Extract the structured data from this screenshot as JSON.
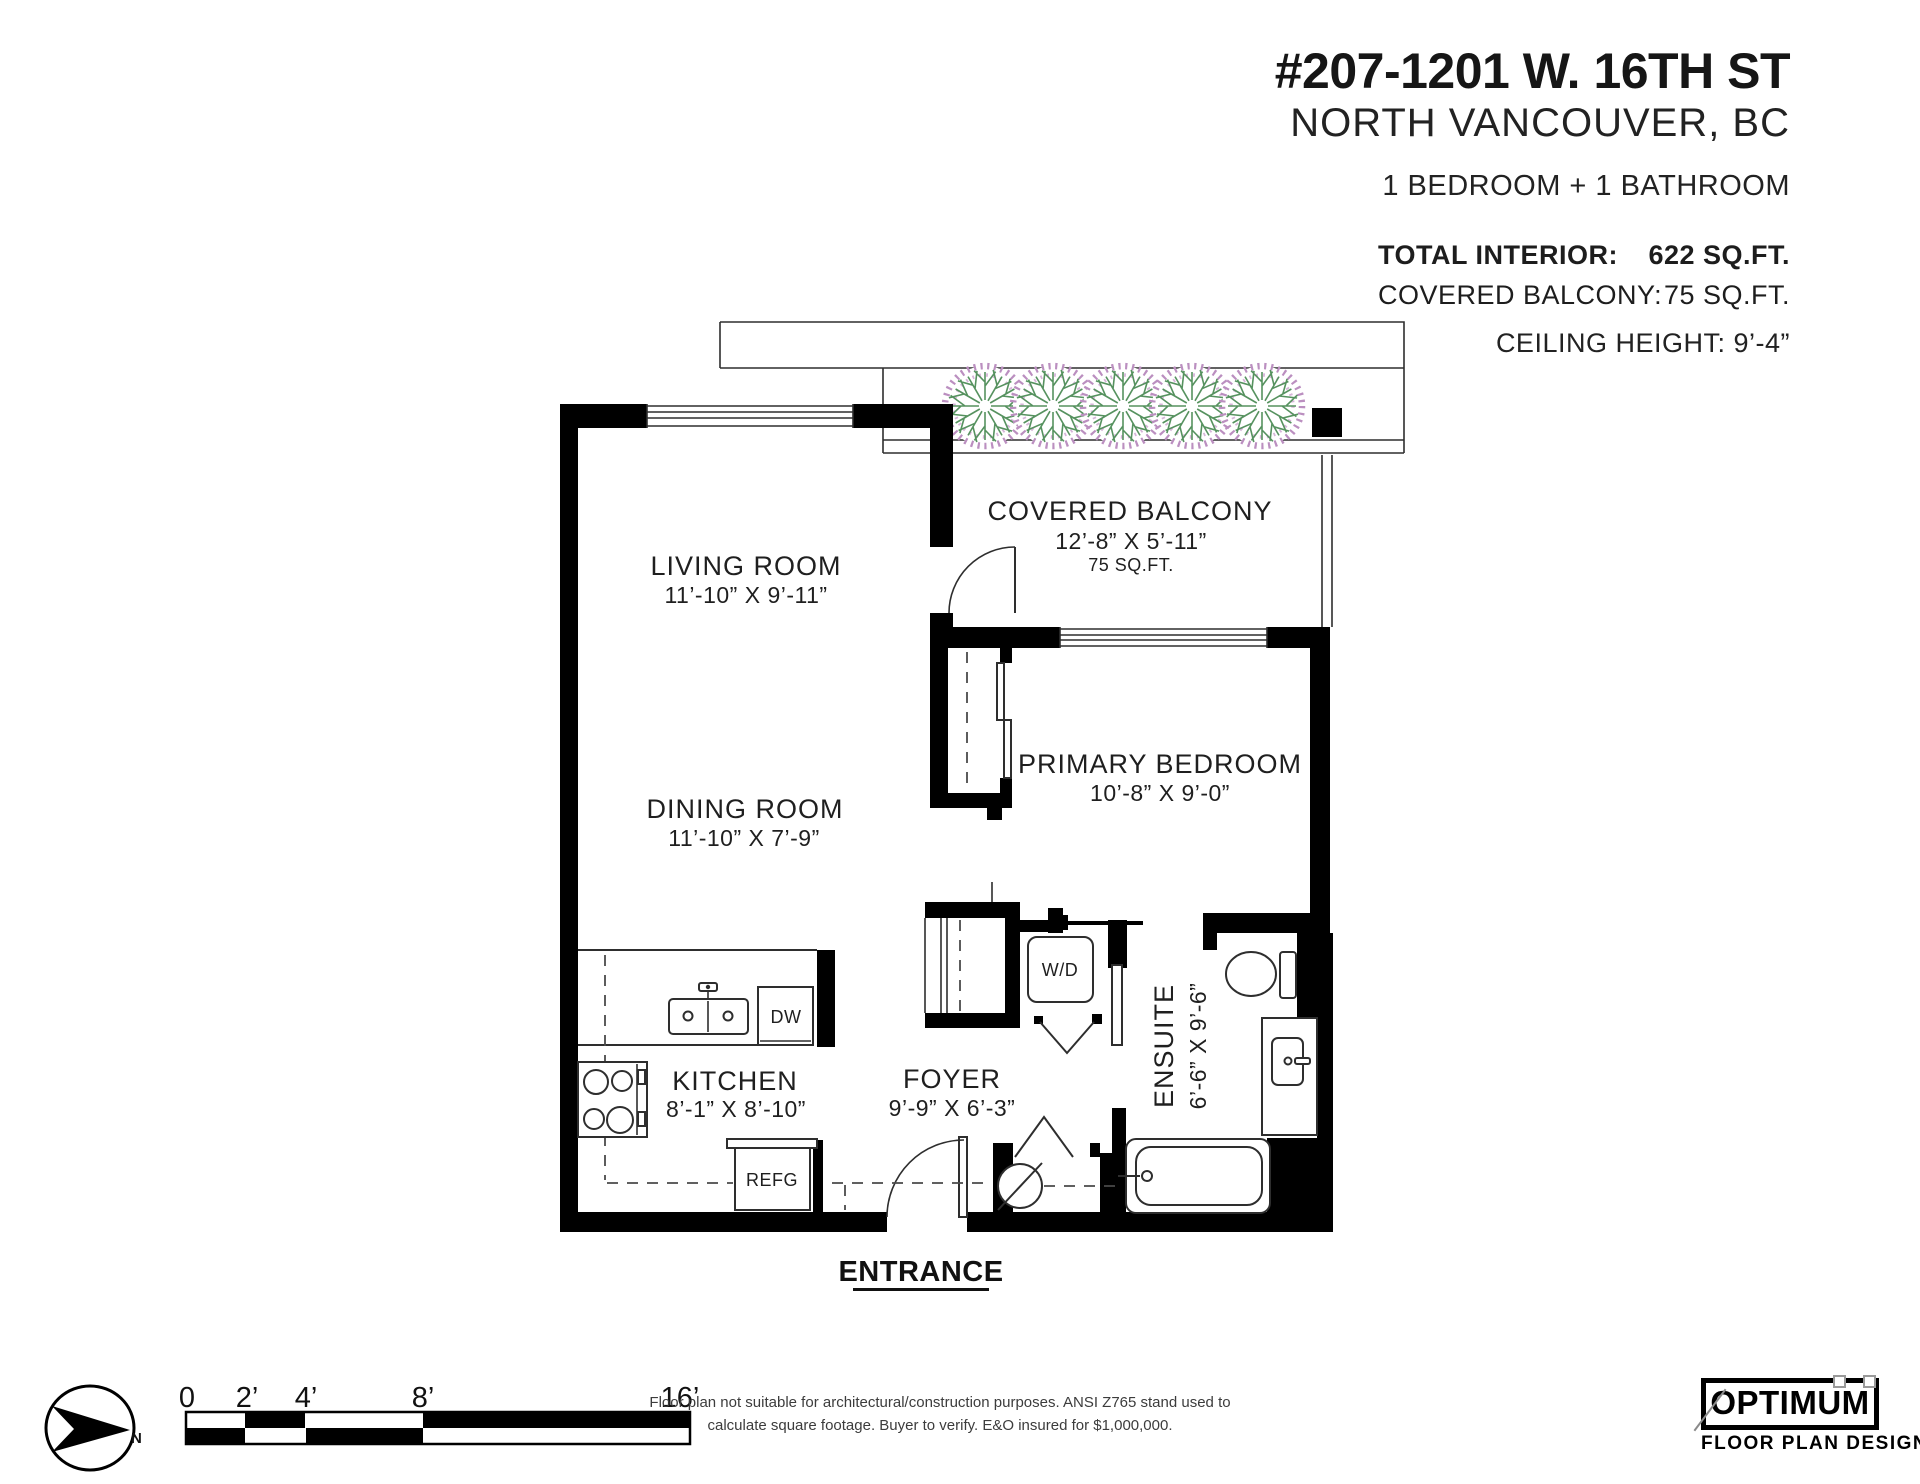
{
  "header": {
    "address": "#207-1201 W. 16TH ST",
    "city": "NORTH VANCOUVER, BC",
    "bedbath": "1 BEDROOM + 1 BATHROOM",
    "total_interior_label": "TOTAL INTERIOR:",
    "total_interior_value": "622 SQ.FT.",
    "covered_balcony_label": "COVERED BALCONY:",
    "covered_balcony_value": "75 SQ.FT.",
    "ceiling_height": "CEILING HEIGHT: 9’-4”"
  },
  "rooms": {
    "living": {
      "name": "LIVING ROOM",
      "dims": "11’-10” X 9’-11”"
    },
    "dining": {
      "name": "DINING ROOM",
      "dims": "11’-10” X 7’-9”"
    },
    "kitchen": {
      "name": "KITCHEN",
      "dims": "8’-1” X 8’-10”"
    },
    "foyer": {
      "name": "FOYER",
      "dims": "9’-9” X 6’-3”"
    },
    "bedroom": {
      "name": "PRIMARY BEDROOM",
      "dims": "10’-8” X 9’-0”"
    },
    "balcony": {
      "name": "COVERED BALCONY",
      "dims": "12’-8” X 5’-11”",
      "area": "75 SQ.FT."
    },
    "ensuite": {
      "name": "ENSUITE",
      "dims": "6’-6” X 9’-6”"
    }
  },
  "labels": {
    "washer_dryer": "W/D",
    "dishwasher": "DW",
    "refrigerator": "REFG",
    "entrance": "ENTRANCE",
    "north": "N"
  },
  "scale_bar": {
    "ticks": [
      "0",
      "2’",
      "4’",
      "8’",
      "16’"
    ]
  },
  "disclaimer": {
    "line1": "Floor plan not suitable for architectural/construction purposes. ANSI Z765 stand used to",
    "line2": "calculate square footage. Buyer to verify.  E&O insured for $1,000,000."
  },
  "logo": {
    "brand": "OPTIMUM",
    "tagline": "FLOOR PLAN DESIGNS"
  },
  "colors": {
    "walls": "#000000",
    "lines": "#2e2e2e",
    "tree_green": "#56925f",
    "tree_pink": "#bb8fc0",
    "text": "#1d1d1d"
  }
}
